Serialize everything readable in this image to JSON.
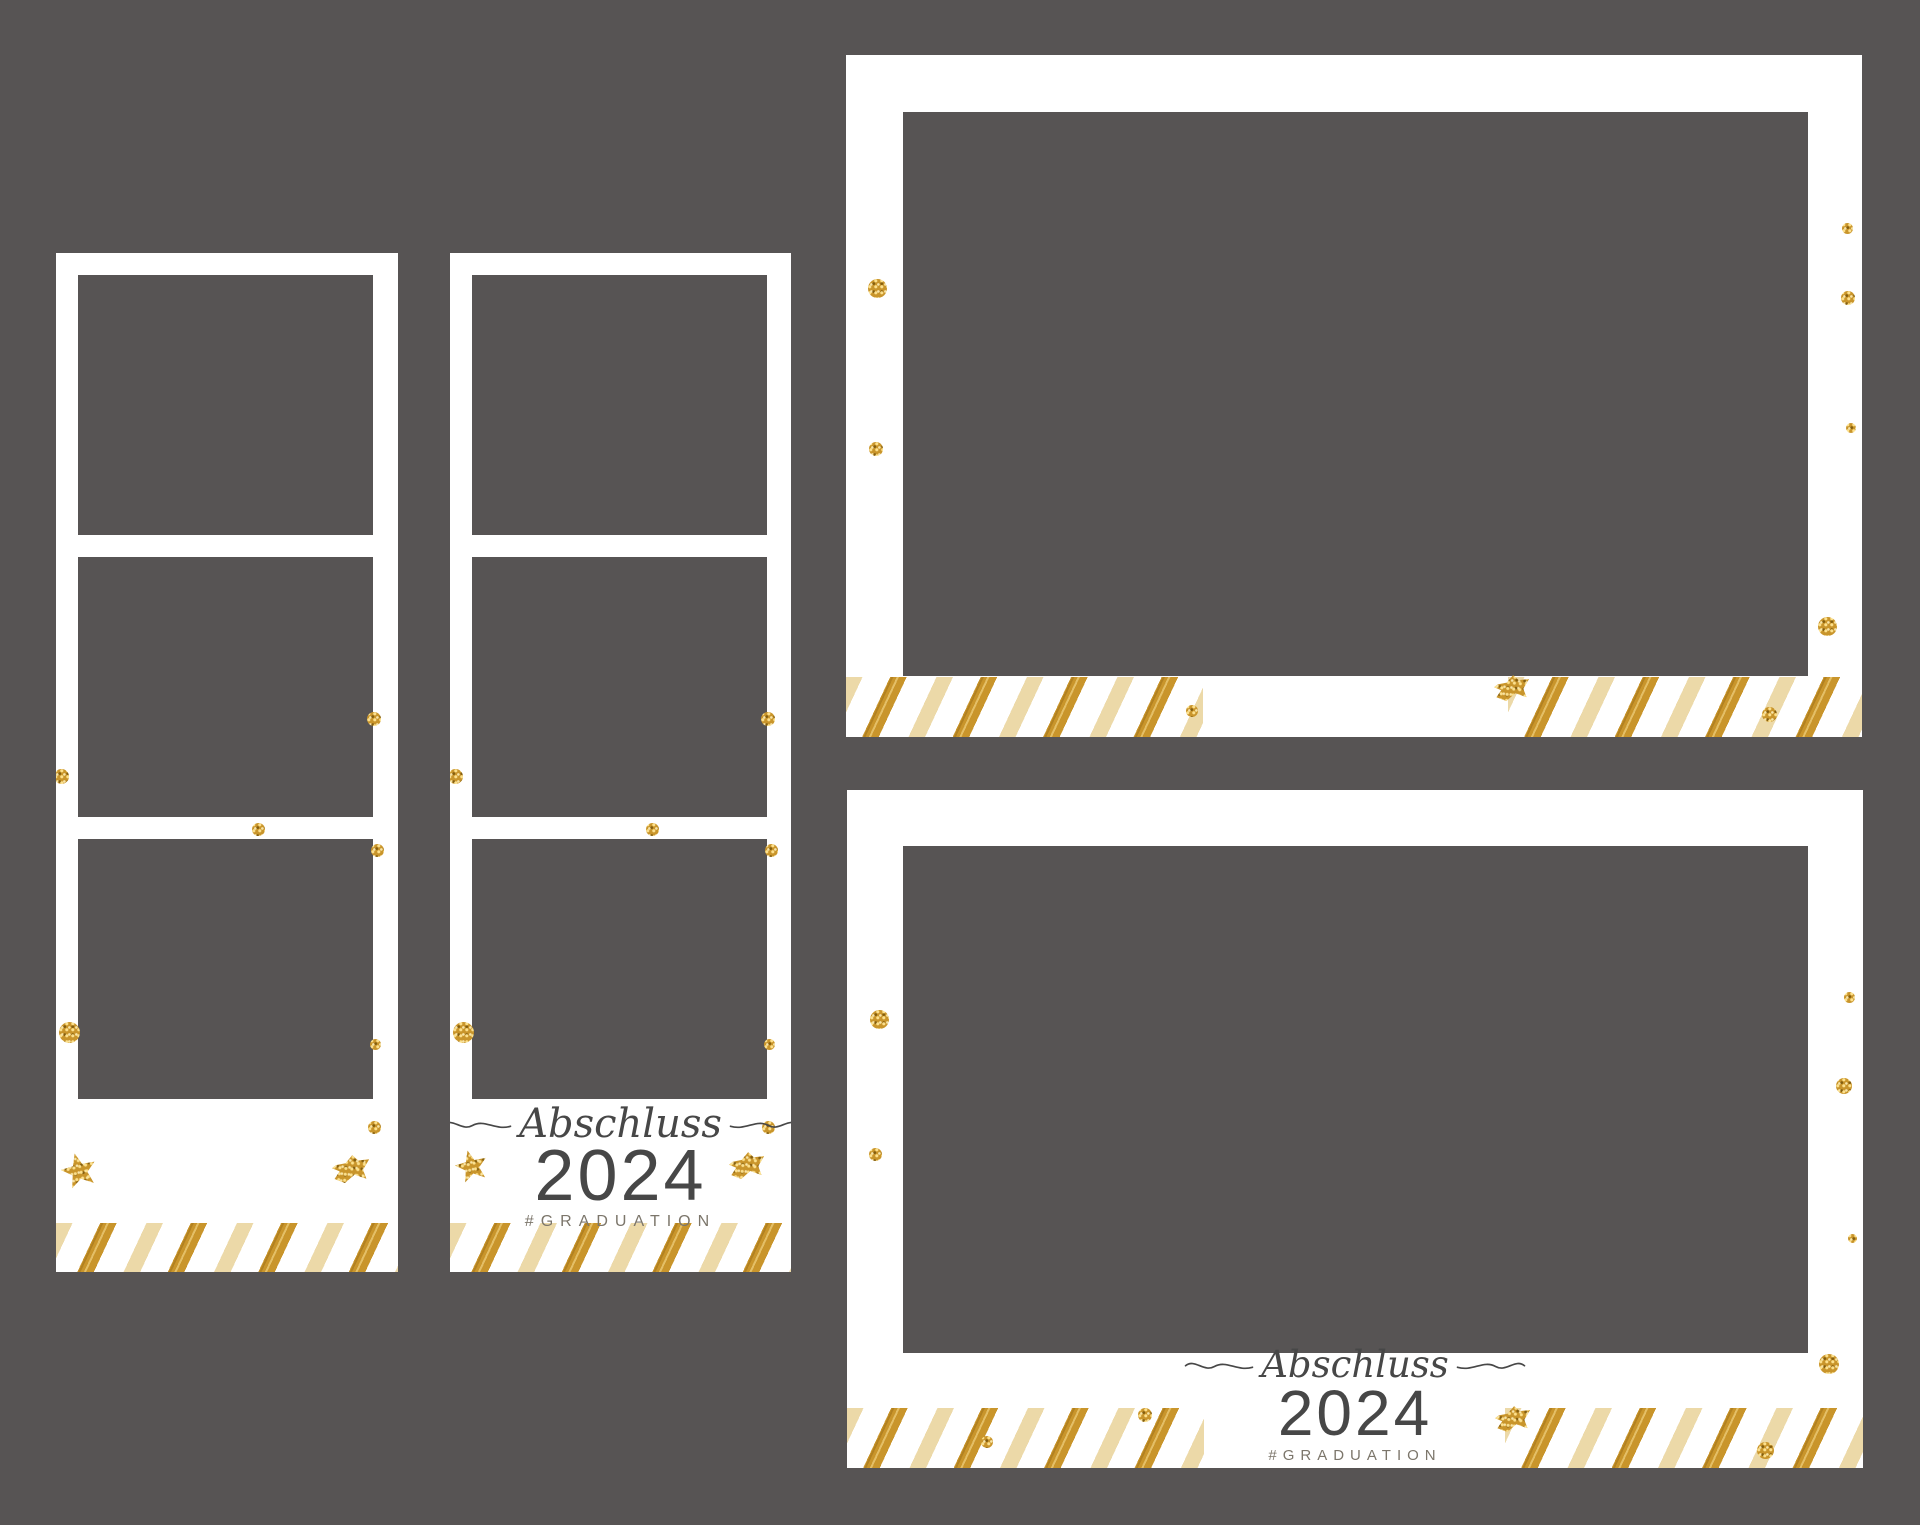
{
  "canvas": {
    "width": 1920,
    "height": 1525,
    "background": "#575454"
  },
  "palette": {
    "frame_white": "#ffffff",
    "photo_placeholder_gray": "#575454",
    "gold_glitter": "#c9952b",
    "cream_stripe": "#ecd9a8",
    "text_dark": "#474747",
    "text_muted": "#7c766b"
  },
  "label": {
    "script": "Abschluss",
    "year": "2024",
    "hashtag": "#GRADUATION"
  },
  "templates": [
    {
      "id": "strip-1",
      "kind": "photo-strip-blank",
      "x": 56,
      "y": 253,
      "w": 342,
      "h": 1019,
      "slots": [
        {
          "x": 22,
          "y": 22,
          "w": 295,
          "h": 260
        },
        {
          "x": 22,
          "y": 304,
          "w": 295,
          "h": 260
        },
        {
          "x": 22,
          "y": 586,
          "w": 295,
          "h": 260
        }
      ],
      "bands": [
        {
          "x": 0,
          "y": 970,
          "w": 342,
          "h": 49
        }
      ],
      "decor": [
        {
          "shape": "dot",
          "x": -2,
          "y": 516,
          "w": 15,
          "h": 15
        },
        {
          "shape": "dot",
          "x": 311,
          "y": 459,
          "w": 14,
          "h": 14
        },
        {
          "shape": "dot",
          "x": 196,
          "y": 570,
          "w": 13,
          "h": 13
        },
        {
          "shape": "dot",
          "x": 315,
          "y": 591,
          "w": 13,
          "h": 13
        },
        {
          "shape": "dot",
          "x": 3,
          "y": 769,
          "w": 21,
          "h": 21
        },
        {
          "shape": "dot",
          "x": 314,
          "y": 786,
          "w": 11,
          "h": 11
        },
        {
          "shape": "dot",
          "x": 312,
          "y": 868,
          "w": 13,
          "h": 13
        },
        {
          "shape": "star",
          "x": 5,
          "y": 900,
          "w": 36,
          "h": 36
        },
        {
          "shape": "bow",
          "x": 276,
          "y": 902,
          "w": 36,
          "h": 29
        }
      ]
    },
    {
      "id": "strip-2",
      "kind": "photo-strip-labeled",
      "x": 450,
      "y": 253,
      "w": 341,
      "h": 1019,
      "slots": [
        {
          "x": 22,
          "y": 22,
          "w": 295,
          "h": 260
        },
        {
          "x": 22,
          "y": 304,
          "w": 295,
          "h": 260
        },
        {
          "x": 22,
          "y": 586,
          "w": 295,
          "h": 260
        }
      ],
      "bands": [
        {
          "x": 0,
          "y": 970,
          "w": 341,
          "h": 49
        }
      ],
      "decor": [
        {
          "shape": "dot",
          "x": -2,
          "y": 516,
          "w": 15,
          "h": 15
        },
        {
          "shape": "dot",
          "x": 311,
          "y": 459,
          "w": 14,
          "h": 14
        },
        {
          "shape": "dot",
          "x": 196,
          "y": 570,
          "w": 13,
          "h": 13
        },
        {
          "shape": "dot",
          "x": 315,
          "y": 591,
          "w": 13,
          "h": 13
        },
        {
          "shape": "dot",
          "x": 3,
          "y": 769,
          "w": 21,
          "h": 21
        },
        {
          "shape": "dot",
          "x": 314,
          "y": 786,
          "w": 11,
          "h": 11
        },
        {
          "shape": "dot",
          "x": 312,
          "y": 868,
          "w": 13,
          "h": 13
        },
        {
          "shape": "star",
          "x": 5,
          "y": 897,
          "w": 33,
          "h": 33
        },
        {
          "shape": "bow",
          "x": 279,
          "y": 899,
          "w": 34,
          "h": 28
        }
      ]
    },
    {
      "id": "landscape-1",
      "kind": "landscape-blank",
      "x": 846,
      "y": 55,
      "w": 1016,
      "h": 682,
      "slots": [
        {
          "x": 57,
          "y": 57,
          "w": 905,
          "h": 564
        }
      ],
      "bands": [
        {
          "x": 0,
          "y": 622,
          "w": 357,
          "h": 60
        },
        {
          "x": 662,
          "y": 622,
          "w": 354,
          "h": 60
        }
      ],
      "decor": [
        {
          "shape": "dot",
          "x": 22,
          "y": 224,
          "w": 19,
          "h": 19
        },
        {
          "shape": "dot",
          "x": 23,
          "y": 387,
          "w": 14,
          "h": 14
        },
        {
          "shape": "dot",
          "x": 996,
          "y": 168,
          "w": 11,
          "h": 11
        },
        {
          "shape": "dot",
          "x": 995,
          "y": 236,
          "w": 14,
          "h": 14
        },
        {
          "shape": "dot",
          "x": 1000,
          "y": 368,
          "w": 10,
          "h": 10
        },
        {
          "shape": "dot",
          "x": 972,
          "y": 562,
          "w": 19,
          "h": 19
        },
        {
          "shape": "dot",
          "x": 916,
          "y": 652,
          "w": 15,
          "h": 15
        },
        {
          "shape": "dot",
          "x": 340,
          "y": 650,
          "w": 12,
          "h": 12
        },
        {
          "shape": "bow",
          "x": 648,
          "y": 620,
          "w": 34,
          "h": 27
        }
      ]
    },
    {
      "id": "landscape-2",
      "kind": "landscape-labeled",
      "x": 847,
      "y": 790,
      "w": 1016,
      "h": 678,
      "slots": [
        {
          "x": 56,
          "y": 56,
          "w": 905,
          "h": 507
        }
      ],
      "bands": [
        {
          "x": 0,
          "y": 618,
          "w": 357,
          "h": 60
        },
        {
          "x": 658,
          "y": 618,
          "w": 358,
          "h": 60
        }
      ],
      "decor": [
        {
          "shape": "dot",
          "x": 23,
          "y": 220,
          "w": 19,
          "h": 19
        },
        {
          "shape": "dot",
          "x": 22,
          "y": 358,
          "w": 13,
          "h": 13
        },
        {
          "shape": "dot",
          "x": 997,
          "y": 202,
          "w": 11,
          "h": 11
        },
        {
          "shape": "dot",
          "x": 989,
          "y": 288,
          "w": 16,
          "h": 16
        },
        {
          "shape": "dot",
          "x": 1001,
          "y": 444,
          "w": 9,
          "h": 9
        },
        {
          "shape": "dot",
          "x": 972,
          "y": 564,
          "w": 20,
          "h": 20
        },
        {
          "shape": "dot",
          "x": 910,
          "y": 652,
          "w": 17,
          "h": 17
        },
        {
          "shape": "dot",
          "x": 291,
          "y": 618,
          "w": 14,
          "h": 14
        },
        {
          "shape": "dot",
          "x": 134,
          "y": 646,
          "w": 12,
          "h": 12
        },
        {
          "shape": "bow",
          "x": 648,
          "y": 616,
          "w": 34,
          "h": 27
        }
      ]
    }
  ]
}
